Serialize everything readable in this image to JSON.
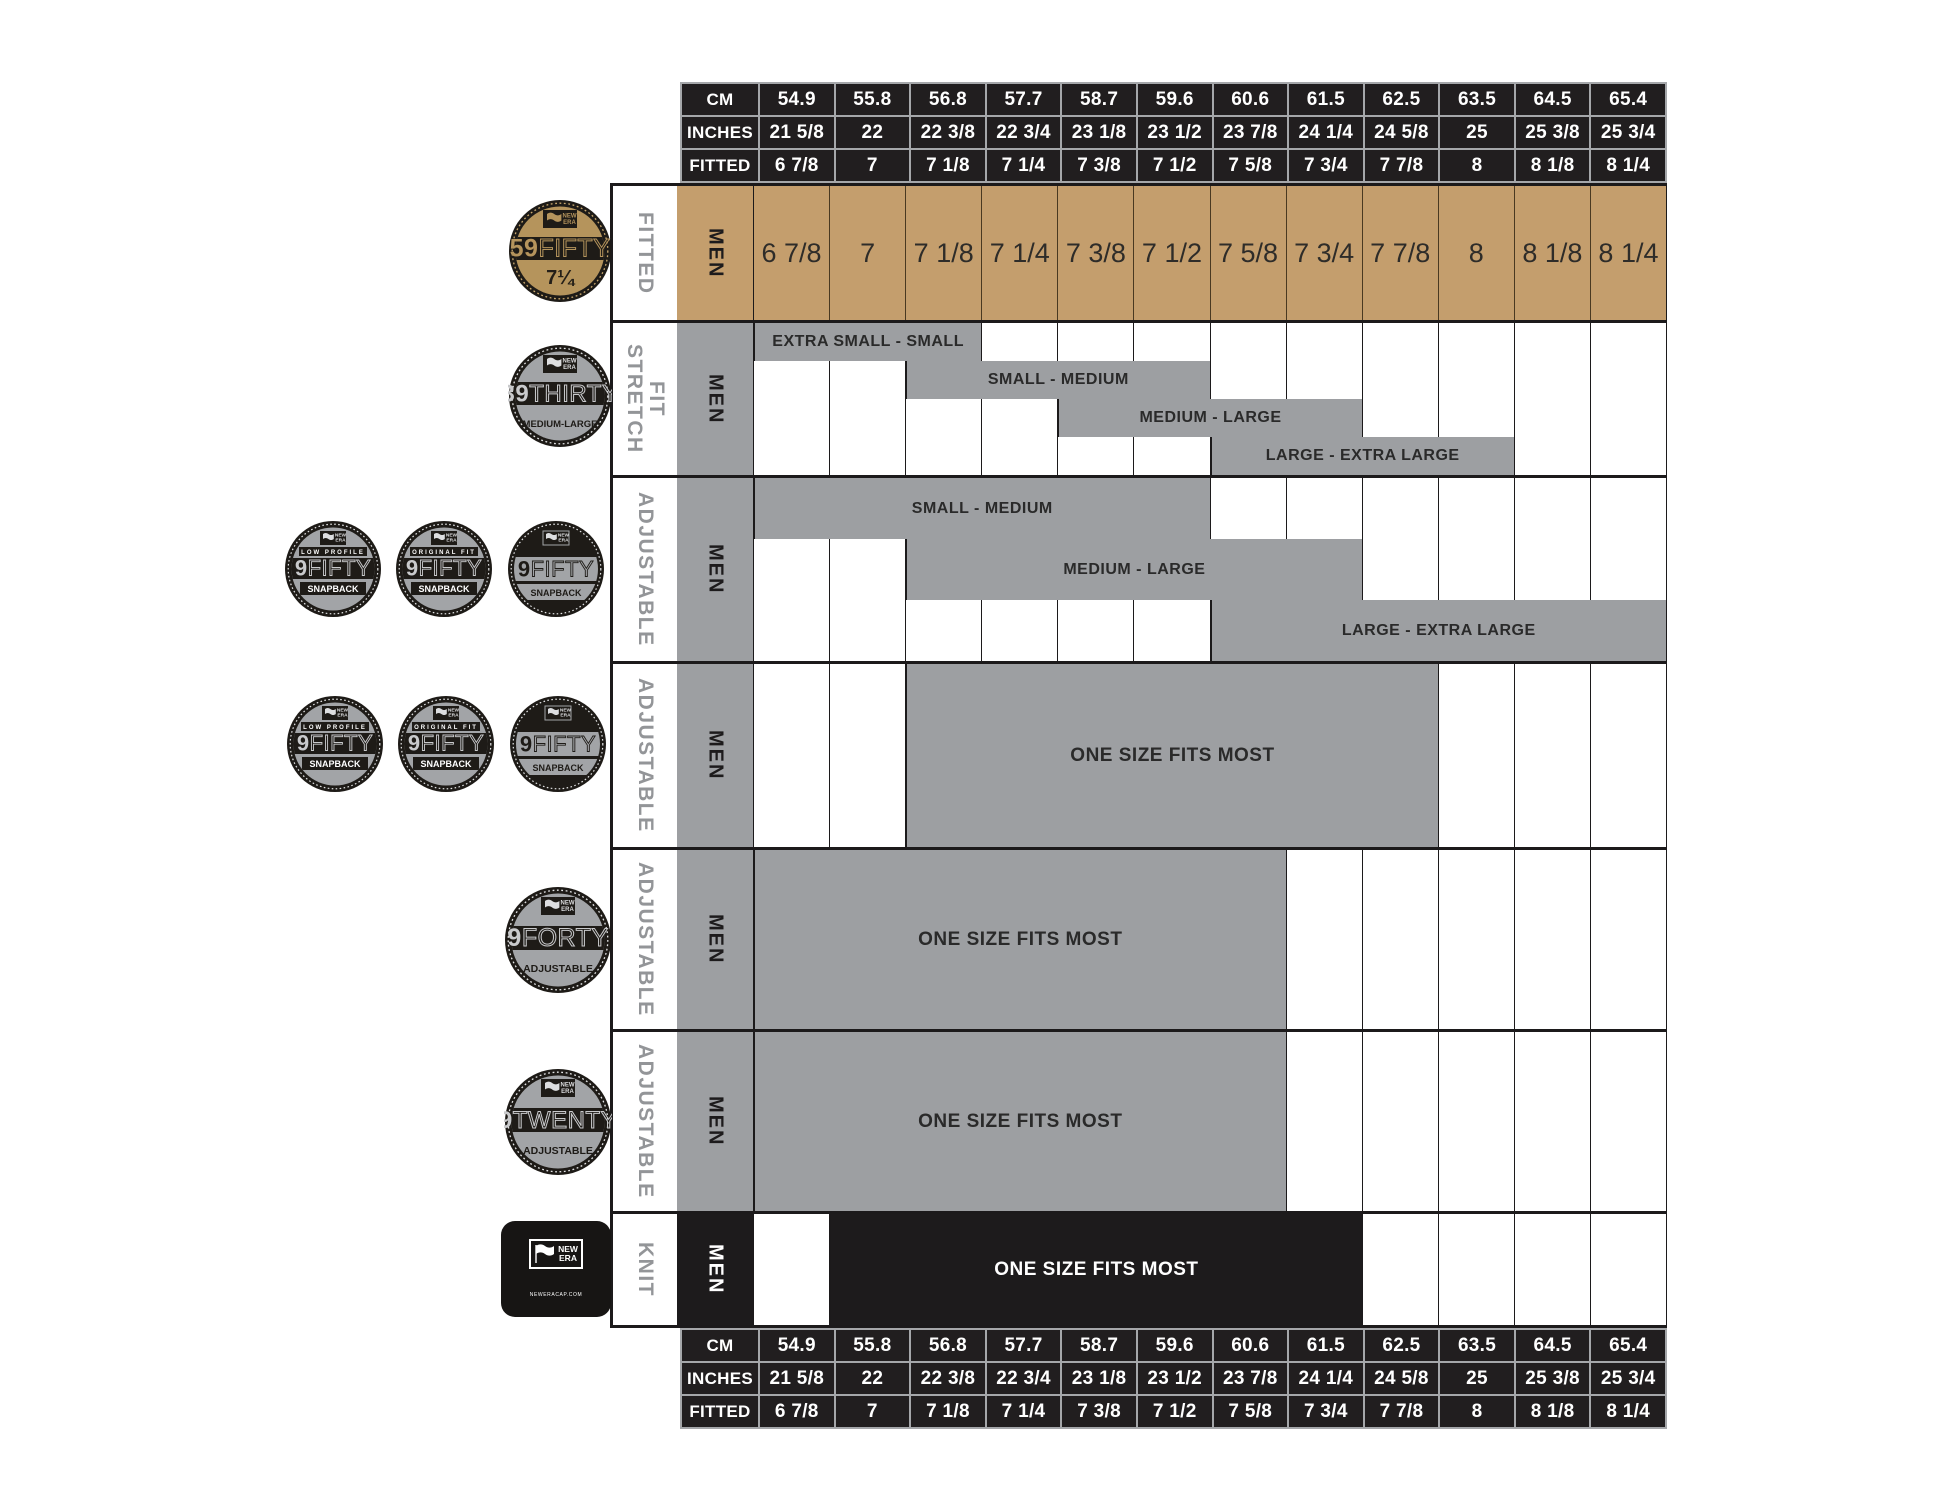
{
  "colors": {
    "black": "#211e1f",
    "tan": "#c49e6d",
    "gray": "#9d9fa2",
    "badge_tan": "#b5945c",
    "badge_gray": "#a2a4a7",
    "label_gray": "#939598"
  },
  "header": {
    "cm": "CM",
    "inches": "INCHES",
    "fitted": "FITTED"
  },
  "columns": {
    "cm": [
      "54.9",
      "55.8",
      "56.8",
      "57.7",
      "58.7",
      "59.6",
      "60.6",
      "61.5",
      "62.5",
      "63.5",
      "64.5",
      "65.4"
    ],
    "inches": [
      "21 5/8",
      "22",
      "22 3/8",
      "22 3/4",
      "23 1/8",
      "23 1/2",
      "23 7/8",
      "24 1/4",
      "24 5/8",
      "25",
      "25 3/8",
      "25 3/4"
    ],
    "fitted": [
      "6 7/8",
      "7",
      "7 1/8",
      "7 1/4",
      "7 3/8",
      "7 1/2",
      "7 5/8",
      "7 3/4",
      "7 7/8",
      "8",
      "8 1/8",
      "8 1/4"
    ]
  },
  "rows": [
    {
      "fit": "FITTED",
      "gender": "MEN",
      "product": "59FIFTY"
    },
    {
      "fit": "STRETCH FIT",
      "gender": "MEN",
      "product": "39THIRTY",
      "bands": [
        {
          "label": "EXTRA SMALL - SMALL",
          "start": 1,
          "end": 4,
          "row": 1
        },
        {
          "label": "SMALL - MEDIUM",
          "start": 3,
          "end": 7,
          "row": 2
        },
        {
          "label": "MEDIUM - LARGE",
          "start": 5,
          "end": 9,
          "row": 3
        },
        {
          "label": "LARGE - EXTRA LARGE",
          "start": 7,
          "end": 11,
          "row": 4
        }
      ]
    },
    {
      "fit": "ADJUSTABLE",
      "gender": "MEN",
      "product": "9FIFTY SNAPBACK",
      "bands": [
        {
          "label": "SMALL - MEDIUM",
          "start": 1,
          "end": 7,
          "row": 1
        },
        {
          "label": "MEDIUM - LARGE",
          "start": 3,
          "end": 9,
          "row": 2
        },
        {
          "label": "LARGE - EXTRA LARGE",
          "start": 7,
          "end": 13,
          "row": 3
        }
      ]
    },
    {
      "fit": "ADJUSTABLE",
      "gender": "MEN",
      "product": "9FIFTY SNAPBACK",
      "bands": [
        {
          "label": "ONE SIZE FITS MOST",
          "start": 3,
          "end": 10,
          "row": 1
        }
      ]
    },
    {
      "fit": "ADJUSTABLE",
      "gender": "MEN",
      "product": "9FORTY",
      "bands": [
        {
          "label": "ONE SIZE FITS MOST",
          "start": 1,
          "end": 8,
          "row": 1
        }
      ]
    },
    {
      "fit": "ADJUSTABLE",
      "gender": "MEN",
      "product": "9TWENTY",
      "bands": [
        {
          "label": "ONE SIZE FITS MOST",
          "start": 1,
          "end": 8,
          "row": 1
        }
      ]
    },
    {
      "fit": "KNIT",
      "gender": "MEN",
      "product": "KNIT",
      "bands": [
        {
          "label": "ONE SIZE FITS MOST",
          "start": 2,
          "end": 9,
          "row": 1,
          "dark": true
        }
      ]
    }
  ],
  "badges": {
    "brand": [
      "NEW",
      "ERA"
    ],
    "b59": {
      "num": "59",
      "word": "FIFTY",
      "sub": "7¼"
    },
    "b39": {
      "num": "39",
      "word": "THIRTY",
      "sub": "MEDIUM-LARGE"
    },
    "lp": {
      "top": "LOW PROFILE",
      "num": "9",
      "word": "FIFTY",
      "sub": "SNAPBACK"
    },
    "of": {
      "top": "ORIGINAL FIT",
      "num": "9",
      "word": "FIFTY",
      "sub": "SNAPBACK"
    },
    "sb": {
      "num": "9",
      "word": "FIFTY",
      "sub": "SNAPBACK"
    },
    "b40": {
      "num": "9",
      "word": "FORTY",
      "sub": "ADJUSTABLE"
    },
    "b20": {
      "num": "9",
      "word": "TWENTY",
      "sub": "ADJUSTABLE"
    },
    "knit": {
      "site": "NEWERACAP.COM"
    }
  },
  "chart_data": {
    "type": "table",
    "title": "New Era cap size chart (Men)",
    "columns": {
      "cm": [
        "54.9",
        "55.8",
        "56.8",
        "57.7",
        "58.7",
        "59.6",
        "60.6",
        "61.5",
        "62.5",
        "63.5",
        "64.5",
        "65.4"
      ],
      "inches": [
        "21 5/8",
        "22",
        "22 3/8",
        "22 3/4",
        "23 1/8",
        "23 1/2",
        "23 7/8",
        "24 1/4",
        "24 5/8",
        "25",
        "25 3/8",
        "25 3/4"
      ],
      "fitted": [
        "6 7/8",
        "7",
        "7 1/8",
        "7 1/4",
        "7 3/8",
        "7 1/2",
        "7 5/8",
        "7 3/4",
        "7 7/8",
        "8",
        "8 1/8",
        "8 1/4"
      ]
    },
    "rows": [
      {
        "product": "59FIFTY",
        "fit": "FITTED",
        "coverage": {
          "individual fitted sizes": "6 7/8 to 8 1/4"
        }
      },
      {
        "product": "39THIRTY",
        "fit": "STRETCH FIT",
        "coverage": {
          "EXTRA SMALL - SMALL": "6 7/8 to 7 1/8",
          "SMALL - MEDIUM": "7 1/8 to 7 1/2",
          "MEDIUM - LARGE": "7 3/8 to 7 3/4",
          "LARGE - EXTRA LARGE": "7 5/8 to 8"
        }
      },
      {
        "product": "9FIFTY SNAPBACK",
        "fit": "ADJUSTABLE",
        "coverage": {
          "SMALL - MEDIUM": "6 7/8 to 7 1/2",
          "MEDIUM - LARGE": "7 1/8 to 7 3/4",
          "LARGE - EXTRA LARGE": "7 5/8 to 8 1/4"
        }
      },
      {
        "product": "9FIFTY SNAPBACK",
        "fit": "ADJUSTABLE",
        "coverage": {
          "ONE SIZE FITS MOST": "7 1/8 to 7 7/8"
        }
      },
      {
        "product": "9FORTY",
        "fit": "ADJUSTABLE",
        "coverage": {
          "ONE SIZE FITS MOST": "6 7/8 to 7 5/8"
        }
      },
      {
        "product": "9TWENTY",
        "fit": "ADJUSTABLE",
        "coverage": {
          "ONE SIZE FITS MOST": "6 7/8 to 7 5/8"
        }
      },
      {
        "product": "KNIT",
        "fit": "KNIT",
        "coverage": {
          "ONE SIZE FITS MOST": "7 to 7 3/4"
        }
      }
    ]
  }
}
